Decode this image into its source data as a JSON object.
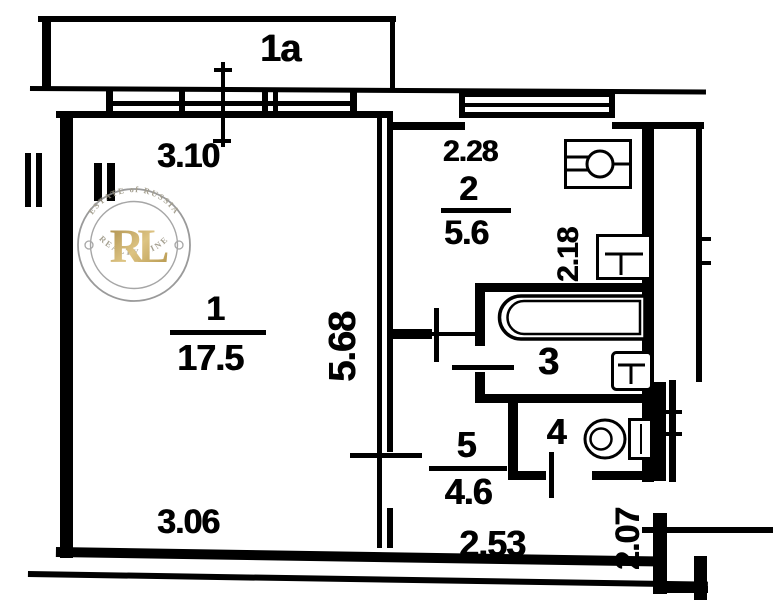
{
  "plan": {
    "balcony": {
      "label": "1a"
    },
    "rooms": {
      "living": {
        "number": "1",
        "area": "17.5"
      },
      "kitchen": {
        "number": "2",
        "area": "5.6"
      },
      "bathroom": {
        "number": "3"
      },
      "toilet": {
        "number": "4"
      },
      "hallway": {
        "number": "5",
        "area": "4.6"
      }
    },
    "dimensions": {
      "living_width_top": "3.10",
      "living_depth": "5.68",
      "living_width_bottom": "3.06",
      "kitchen_width": "2.28",
      "bathroom_depth": "2.18",
      "hallway_width": "2.53",
      "entry_depth": "2.07"
    },
    "fixtures": [
      "stove-icon",
      "kitchen-sink-icon",
      "bathtub-icon",
      "washbasin-icon",
      "toilet-icon"
    ],
    "colors": {
      "ink": "#000000",
      "paper": "#ffffff",
      "watermark_gold": "#b5913c",
      "watermark_ring": "#8d8d8d"
    }
  },
  "watermark": {
    "initials": "RL",
    "arc_top": "ESTATE of RUSSIA",
    "arc_bottom": "REALTY LINE"
  }
}
